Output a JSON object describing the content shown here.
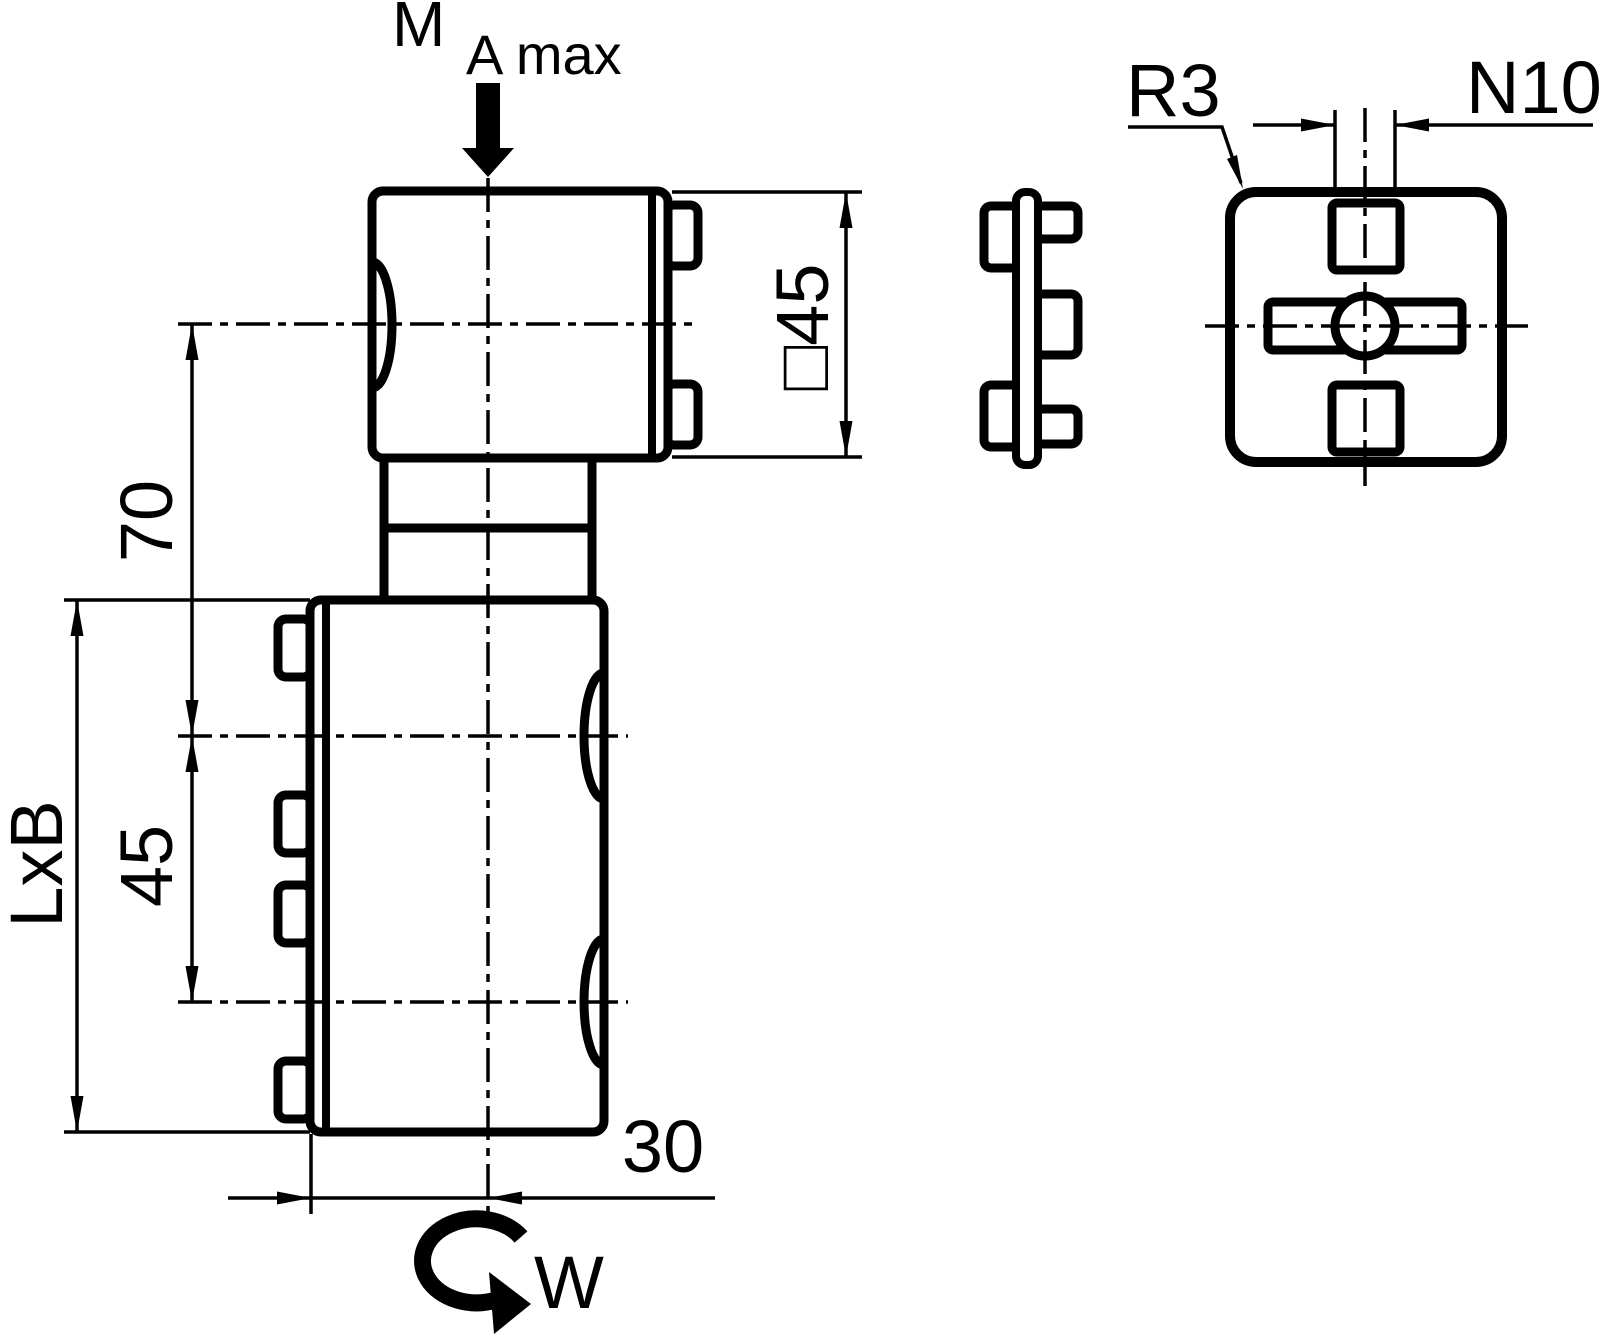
{
  "front": {
    "torque_main": "M",
    "torque_sub": "A max",
    "dim_top_to_first_axis": "70",
    "dim_axis_spacing": "45",
    "dim_body_length": "LxB",
    "dim_axis_offset": "30",
    "dim_head_square": "□45",
    "rotation": "W"
  },
  "end_view": {
    "corner_radius": "R3",
    "slot_width": "N10"
  },
  "colors": {
    "ink": "#000000",
    "paper": "#ffffff"
  }
}
